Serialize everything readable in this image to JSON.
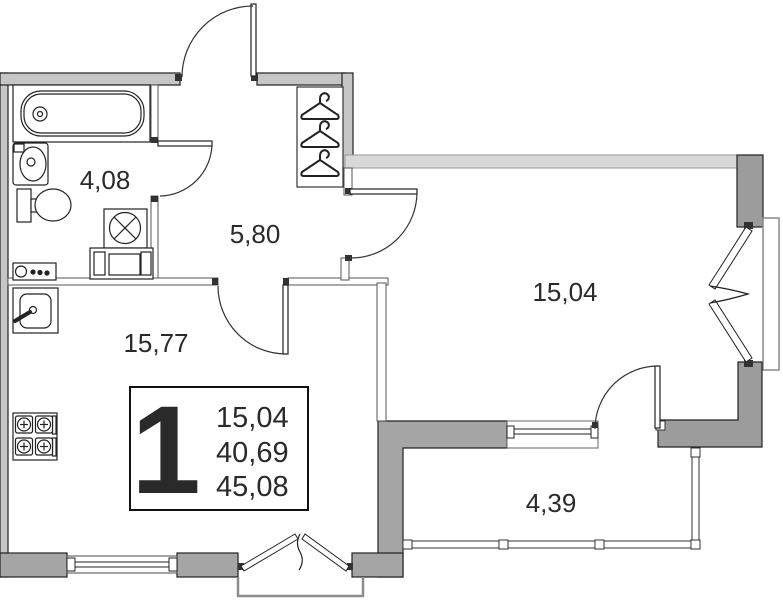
{
  "title": "1-room apartment floor plan",
  "rooms": {
    "bathroom": {
      "name": "bathroom",
      "area": "4,08"
    },
    "hallway": {
      "name": "hallway",
      "area": "5,80"
    },
    "kitchen_living": {
      "name": "kitchen-living",
      "area": "15,77"
    },
    "living_room": {
      "name": "living-room",
      "area": "15,04"
    },
    "balcony": {
      "name": "balcony",
      "area": "4,39"
    }
  },
  "legend": {
    "rooms_count": "1",
    "living_area": "15,04",
    "total_area": "40,69",
    "total_area_with_balcony": "45,08"
  },
  "fixtures": [
    "bathtub-icon",
    "washbasin-icon",
    "toilet-icon",
    "washing-machine-icon",
    "kitchen-unit-icon",
    "kitchen-sink-icon",
    "stove-icon",
    "hanger-icon",
    "door-arc-icon",
    "casement-window-icon"
  ],
  "colors": {
    "wall_light": "#c6c6c6",
    "wall_medium": "#a5a5a5",
    "wall_dark": "#9c9c9c",
    "wall_band": "#d8d8d8",
    "line": "#222222",
    "text": "#2a2a2a"
  }
}
